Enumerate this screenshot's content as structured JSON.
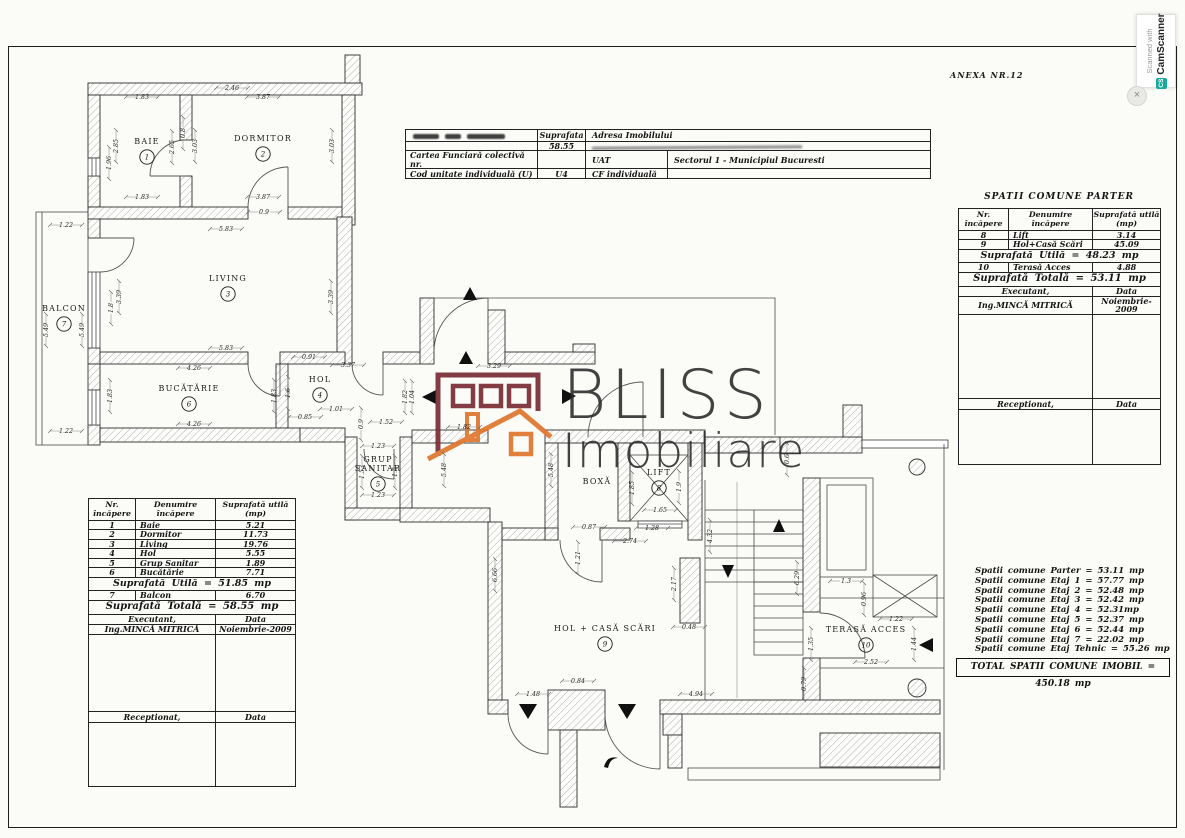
{
  "anexa": "ANEXA NR.12",
  "badge": {
    "line1": "Scanned with",
    "logo": "CS",
    "brand": "CamScanner",
    "close": "×"
  },
  "watermark": {
    "brand": "BLISS",
    "sub": "Imobiliare",
    "colors": {
      "maroon": "#7a2e36",
      "orange": "#e0772f"
    }
  },
  "top_table": {
    "r1": {
      "c2": "Suprafata",
      "c3": "Adresa Imobilului"
    },
    "r2": {
      "c2": "58.55"
    },
    "r3": {
      "c1": "Cartea Funciară colectivă nr.",
      "c3": "UAT",
      "c4": "Sectorul 1 - Municipiul Bucuresti"
    },
    "r4": {
      "c1": "Cod unitate individuală (U)",
      "c2": "U4",
      "c3": "CF individuală"
    }
  },
  "left_table": {
    "headers": {
      "c1a": "Nr.",
      "c1b": "încăpere",
      "c2a": "Denumire",
      "c2b": "încăpere",
      "c3a": "Suprafată utilă",
      "c3b": "(mp)"
    },
    "rows": [
      {
        "nr": "1",
        "den": "Baie",
        "val": "5.21"
      },
      {
        "nr": "2",
        "den": "Dormitor",
        "val": "11.73"
      },
      {
        "nr": "3",
        "den": "Living",
        "val": "19.76"
      },
      {
        "nr": "4",
        "den": "Hol",
        "val": "5.55"
      },
      {
        "nr": "5",
        "den": "Grup Sanitar",
        "val": "1.89"
      },
      {
        "nr": "6",
        "den": "Bucătărie",
        "val": "7.71"
      }
    ],
    "subtotal": "Suprafată Utilă = 51.85 mp",
    "balcon": {
      "nr": "7",
      "den": "Balcon",
      "val": "6.70"
    },
    "total": "Suprafată Totală = 58.55 mp",
    "executant_label": "Executant,",
    "data_label": "Data",
    "executant_name": "Ing.MINCĂ MITRICĂ",
    "date": "Noiembrie-2009",
    "receptionat_label": "Receptionat,"
  },
  "right_table": {
    "title": "SPATII COMUNE PARTER",
    "headers": {
      "c1a": "Nr.",
      "c1b": "încăpere",
      "c2a": "Denumire",
      "c2b": "încăpere",
      "c3a": "Suprafată utilă",
      "c3b": "(mp)"
    },
    "rows": [
      {
        "nr": "8",
        "den": "Lift",
        "val": "3.14"
      },
      {
        "nr": "9",
        "den": "Hol+Casă Scări",
        "val": "45.09"
      }
    ],
    "subtotal": "Suprafată Utilă = 48.23 mp",
    "terasa": {
      "nr": "10",
      "den": "Terasă Acces",
      "val": "4.88"
    },
    "total": "Suprafată Totală = 53.11 mp",
    "executant_label": "Executant,",
    "data_label": "Data",
    "executant_name": "Ing.MINCĂ MITRICĂ",
    "date": "Noiembrie-2009",
    "receptionat_label": "Receptionat,"
  },
  "summary": {
    "lines": [
      "Spatii comune Parter = 53.11 mp",
      "Spatii comune Etaj 1 = 57.77 mp",
      "Spatii comune Etaj 2 = 52.48 mp",
      "Spatii comune Etaj 3 = 52.42 mp",
      "Spatii comune Etaj 4 = 52.31mp",
      "Spatii comune Etaj 5 = 52.37 mp",
      "Spatii comune Etaj 6 = 52.44 mp",
      "Spatii comune Etaj 7 = 22.02 mp",
      "Spatii comune Etaj Tehnic = 55.26 mp"
    ],
    "total": "TOTAL SPATII COMUNE IMOBIL = 450.18 mp"
  },
  "plan": {
    "rooms": [
      {
        "label": "BAIE",
        "num": "1",
        "x": 147,
        "y": 144
      },
      {
        "label": "DORMITOR",
        "num": "2",
        "x": 263,
        "y": 141
      },
      {
        "label": "LIVING",
        "num": "3",
        "x": 228,
        "y": 281
      },
      {
        "label": "HOL",
        "num": "4",
        "x": 320,
        "y": 382
      },
      {
        "label": "GRUP",
        "label2": "SANITAR",
        "num": "5",
        "x": 378,
        "y": 462
      },
      {
        "label": "BUCĂTĂRIE",
        "num": "6",
        "x": 189,
        "y": 391
      },
      {
        "label": "BALCON",
        "num": "7",
        "x": 64,
        "y": 311
      },
      {
        "label": "LIFT",
        "num": "8",
        "x": 659,
        "y": 475
      },
      {
        "label": "BOXĂ",
        "x": 597,
        "y": 484
      },
      {
        "label": "HOL + CASĂ SCĂRI",
        "num": "9",
        "x": 605,
        "y": 631
      },
      {
        "label": "TERASĂ ACCES",
        "num": "10",
        "x": 866,
        "y": 632
      }
    ],
    "dimensions": [
      {
        "t": "1.83",
        "x": 142,
        "y": 99
      },
      {
        "t": "2.46",
        "x": 232,
        "y": 90
      },
      {
        "t": "3.87",
        "x": 263,
        "y": 99
      },
      {
        "t": "1.83",
        "x": 142,
        "y": 199
      },
      {
        "t": "3.87",
        "x": 263,
        "y": 199
      },
      {
        "t": "0.9",
        "x": 264,
        "y": 214
      },
      {
        "t": "2.85",
        "x": 118,
        "y": 146,
        "r": 1
      },
      {
        "t": "1.96",
        "x": 111,
        "y": 163,
        "r": 1
      },
      {
        "t": "2.65",
        "x": 174,
        "y": 147,
        "r": 1
      },
      {
        "t": "0.8",
        "x": 185,
        "y": 133,
        "r": 1
      },
      {
        "t": "3.03",
        "x": 197,
        "y": 146,
        "r": 1
      },
      {
        "t": "3.03",
        "x": 334,
        "y": 146,
        "r": 1
      },
      {
        "t": "5.83",
        "x": 226,
        "y": 231
      },
      {
        "t": "5.83",
        "x": 226,
        "y": 350
      },
      {
        "t": "3.39",
        "x": 121,
        "y": 297,
        "r": 1
      },
      {
        "t": "3.39",
        "x": 333,
        "y": 297,
        "r": 1
      },
      {
        "t": "1.8",
        "x": 113,
        "y": 308,
        "r": 1
      },
      {
        "t": "1.22",
        "x": 66,
        "y": 227
      },
      {
        "t": "1.22",
        "x": 66,
        "y": 433
      },
      {
        "t": "5.49",
        "x": 48,
        "y": 330,
        "r": 1
      },
      {
        "t": "5.49",
        "x": 84,
        "y": 330,
        "r": 1
      },
      {
        "t": "4.26",
        "x": 194,
        "y": 370
      },
      {
        "t": "4.26",
        "x": 194,
        "y": 426
      },
      {
        "t": "1.83",
        "x": 112,
        "y": 396,
        "r": 1
      },
      {
        "t": "1.83",
        "x": 276,
        "y": 396,
        "r": 1
      },
      {
        "t": "1.6",
        "x": 290,
        "y": 393,
        "r": 1
      },
      {
        "t": "0.91",
        "x": 309,
        "y": 359
      },
      {
        "t": "3.37",
        "x": 348,
        "y": 367
      },
      {
        "t": "1.01",
        "x": 336,
        "y": 411
      },
      {
        "t": "0.85",
        "x": 305,
        "y": 419
      },
      {
        "t": "1.52",
        "x": 386,
        "y": 424
      },
      {
        "t": "1.82",
        "x": 464,
        "y": 429
      },
      {
        "t": "3.29",
        "x": 494,
        "y": 368
      },
      {
        "t": "1.82",
        "x": 407,
        "y": 397,
        "r": 1
      },
      {
        "t": "1.04",
        "x": 414,
        "y": 397,
        "r": 1
      },
      {
        "t": "0.9",
        "x": 363,
        "y": 424,
        "r": 1
      },
      {
        "t": "1.23",
        "x": 378,
        "y": 448
      },
      {
        "t": "1.23",
        "x": 378,
        "y": 497
      },
      {
        "t": "1.53",
        "x": 364,
        "y": 472,
        "r": 1
      },
      {
        "t": "1.5",
        "x": 397,
        "y": 472,
        "r": 1
      },
      {
        "t": "1.65",
        "x": 660,
        "y": 512
      },
      {
        "t": "1.85",
        "x": 634,
        "y": 488,
        "r": 1
      },
      {
        "t": "1.9",
        "x": 681,
        "y": 487,
        "r": 1
      },
      {
        "t": "1.28",
        "x": 652,
        "y": 530
      },
      {
        "t": "2.74",
        "x": 630,
        "y": 543
      },
      {
        "t": "0.87",
        "x": 589,
        "y": 529
      },
      {
        "t": "1.21",
        "x": 580,
        "y": 558,
        "r": 1
      },
      {
        "t": "2.17",
        "x": 676,
        "y": 584,
        "r": 1
      },
      {
        "t": "4.32",
        "x": 712,
        "y": 536,
        "r": 1
      },
      {
        "t": "6.29",
        "x": 799,
        "y": 578,
        "r": 1
      },
      {
        "t": "0.6",
        "x": 789,
        "y": 459,
        "r": 1
      },
      {
        "t": "5.48",
        "x": 446,
        "y": 470,
        "r": 1
      },
      {
        "t": "5.48",
        "x": 553,
        "y": 470,
        "r": 1
      },
      {
        "t": "6.66",
        "x": 497,
        "y": 575,
        "r": 1
      },
      {
        "t": "0.48",
        "x": 689,
        "y": 629
      },
      {
        "t": "0.84",
        "x": 578,
        "y": 683
      },
      {
        "t": "1.48",
        "x": 533,
        "y": 696
      },
      {
        "t": "4.94",
        "x": 696,
        "y": 696
      },
      {
        "t": "0.79",
        "x": 806,
        "y": 684,
        "r": 1
      },
      {
        "t": "1.3",
        "x": 846,
        "y": 583
      },
      {
        "t": "0.96",
        "x": 866,
        "y": 599,
        "r": 1
      },
      {
        "t": "1.22",
        "x": 896,
        "y": 621
      },
      {
        "t": "1.44",
        "x": 916,
        "y": 644,
        "r": 1
      },
      {
        "t": "2.52",
        "x": 871,
        "y": 664
      },
      {
        "t": "1.35",
        "x": 813,
        "y": 644,
        "r": 1
      }
    ]
  }
}
